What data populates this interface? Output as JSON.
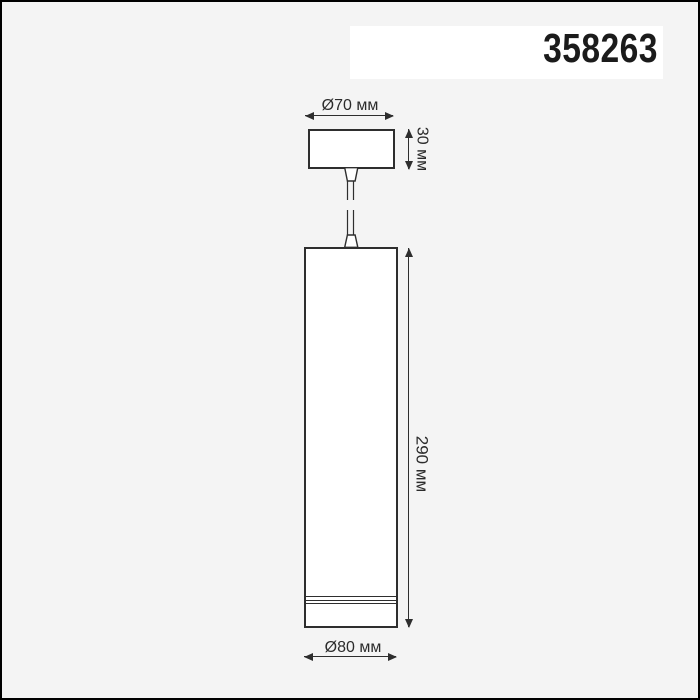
{
  "product": {
    "code": "358263"
  },
  "dimensions": {
    "top_diameter": "Ø70 мм",
    "canopy_height": "30 мм",
    "body_height": "290 мм",
    "body_diameter": "Ø80 мм"
  },
  "colors": {
    "page_background": "#f4f4f4",
    "shape_fill": "#ffffff",
    "outline": "#2e2e2e",
    "code_text": "#1b1b1b",
    "dimension_text": "#2b2b2b",
    "frame_border": "#000000"
  }
}
